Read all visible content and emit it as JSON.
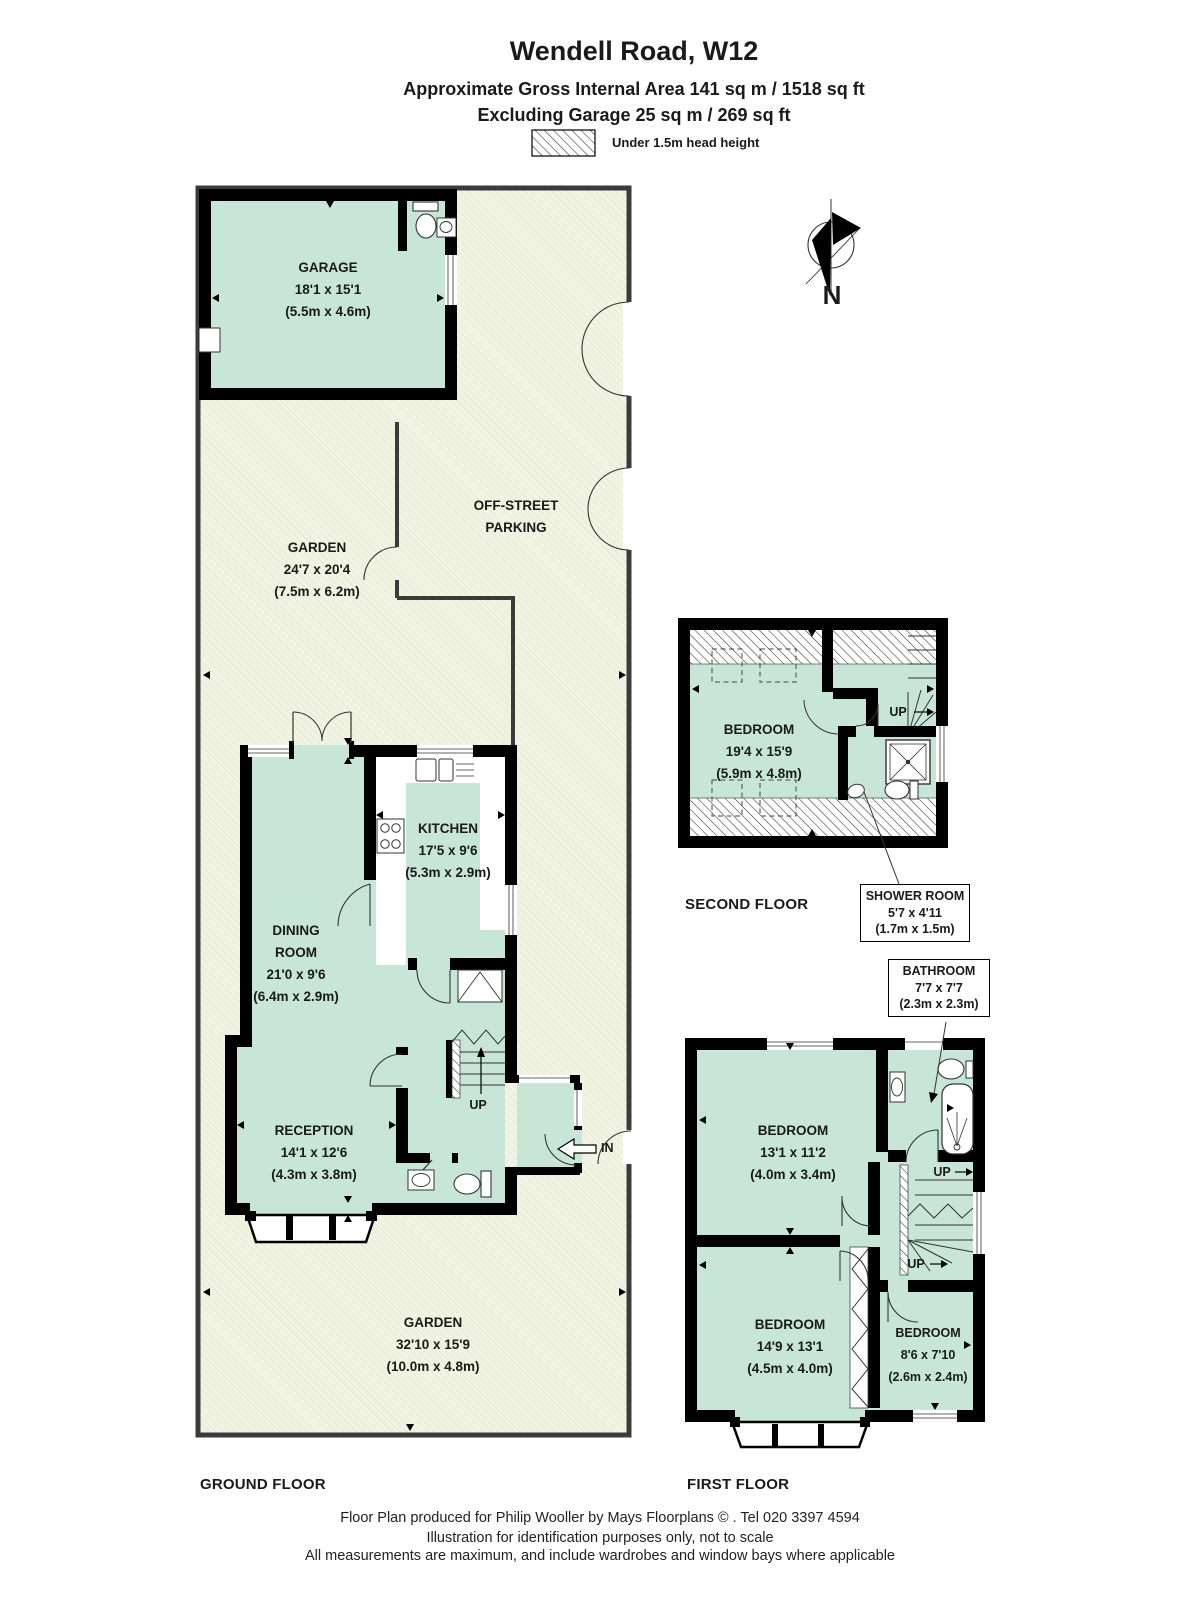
{
  "header": {
    "title": "Wendell Road, W12",
    "area_line": "Approximate Gross Internal Area 141 sq m  /  1518 sq ft",
    "garage_line": "Excluding Garage  25 sq m  /  269 sq ft",
    "legend_label": "Under 1.5m head height"
  },
  "compass": {
    "north": "N"
  },
  "ground": {
    "floor_label": "GROUND FLOOR",
    "garage": {
      "name": "GARAGE",
      "dims_ft": "18'1 x 15'1",
      "dims_m": "(5.5m x 4.6m)"
    },
    "parking": {
      "line1": "OFF-STREET",
      "line2": "PARKING"
    },
    "garden_upper": {
      "name": "GARDEN",
      "dims_ft": "24'7 x 20'4",
      "dims_m": "(7.5m x 6.2m)"
    },
    "kitchen": {
      "name": "KITCHEN",
      "dims_ft": "17'5 x 9'6",
      "dims_m": "(5.3m x 2.9m)"
    },
    "dining": {
      "line1": "DINING",
      "line2": "ROOM",
      "dims_ft": "21'0 x 9'6",
      "dims_m": "(6.4m x 2.9m)"
    },
    "reception": {
      "name": "RECEPTION",
      "dims_ft": "14'1 x 12'6",
      "dims_m": "(4.3m x 3.8m)"
    },
    "garden_lower": {
      "name": "GARDEN",
      "dims_ft": "32'10 x 15'9",
      "dims_m": "(10.0m x 4.8m)"
    },
    "up": "UP",
    "in": "IN"
  },
  "first": {
    "floor_label": "FIRST FLOOR",
    "bedroom_front": {
      "name": "BEDROOM",
      "dims_ft": "13'1 x 11'2",
      "dims_m": "(4.0m x 3.4m)"
    },
    "bedroom_middle": {
      "name": "BEDROOM",
      "dims_ft": "14'9 x 13'1",
      "dims_m": "(4.5m x 4.0m)"
    },
    "bedroom_back": {
      "name": "BEDROOM",
      "dims_ft": "8'6 x 7'10",
      "dims_m": "(2.6m x 2.4m)"
    },
    "bathroom_callout": {
      "name": "BATHROOM",
      "dims_ft": "7'7 x 7'7",
      "dims_m": "(2.3m x 2.3m)"
    },
    "up1": "UP",
    "up2": "UP"
  },
  "second": {
    "floor_label": "SECOND FLOOR",
    "bedroom": {
      "name": "BEDROOM",
      "dims_ft": "19'4 x 15'9",
      "dims_m": "(5.9m x 4.8m)"
    },
    "shower_callout": {
      "name": "SHOWER ROOM",
      "dims_ft": "5'7 x 4'11",
      "dims_m": "(1.7m x 1.5m)"
    },
    "up": "UP"
  },
  "footer": {
    "line1": "Floor Plan produced for Philip Wooller by Mays Floorplans  © . Tel 020 3397 4594",
    "line2": "Illustration for identification purposes only, not to scale",
    "line3": "All measurements are maximum, and include wardrobes and window bays where applicable"
  },
  "colors": {
    "room_fill": "#c8e6d8",
    "garden_fill": "#f1f4e2",
    "wall": "#000000",
    "text": "#1a1a1a"
  }
}
